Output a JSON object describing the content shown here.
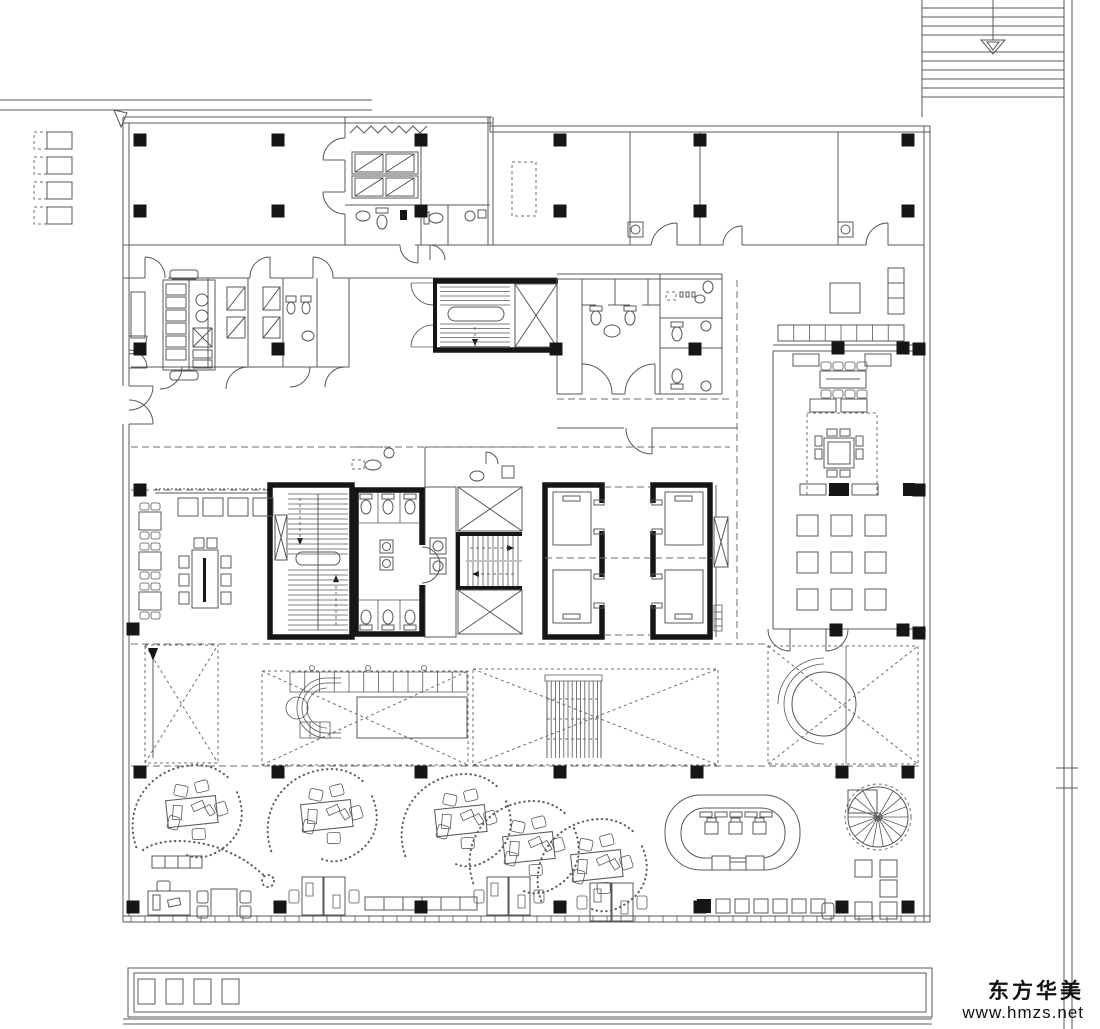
{
  "watermark": {
    "company": "东方华美",
    "website": "www.hmzs.net"
  },
  "palette": {
    "background": "#ffffff",
    "line": "#54585c",
    "dark": "#161616",
    "dashed": "#6b6f73"
  },
  "plan": {
    "columns": [
      [
        140,
        140
      ],
      [
        278,
        140
      ],
      [
        421,
        140
      ],
      [
        560,
        140
      ],
      [
        700,
        140
      ],
      [
        908,
        140
      ],
      [
        140,
        211
      ],
      [
        278,
        211
      ],
      [
        421,
        211
      ],
      [
        560,
        211
      ],
      [
        700,
        211
      ],
      [
        908,
        211
      ],
      [
        140,
        349
      ],
      [
        278,
        349
      ],
      [
        556,
        349
      ],
      [
        695,
        349
      ],
      [
        838,
        348
      ],
      [
        903,
        348
      ],
      [
        919,
        349
      ],
      [
        140,
        490
      ],
      [
        919,
        490
      ],
      [
        133,
        629
      ],
      [
        836,
        630
      ],
      [
        903,
        630
      ],
      [
        919,
        633
      ],
      [
        140,
        772
      ],
      [
        278,
        772
      ],
      [
        421,
        772
      ],
      [
        560,
        772
      ],
      [
        697,
        772
      ],
      [
        842,
        772
      ],
      [
        908,
        772
      ],
      [
        133,
        907
      ],
      [
        280,
        907
      ],
      [
        421,
        907
      ],
      [
        560,
        907
      ],
      [
        700,
        907
      ],
      [
        842,
        907
      ],
      [
        908,
        907
      ]
    ],
    "parking": {
      "x_dash": 34,
      "w_dash": 13,
      "x_solid": 47,
      "w_solid": 25,
      "h": 17,
      "ys": [
        132,
        157,
        182,
        207
      ]
    },
    "exterior_stair": {
      "x1": 922,
      "x2": 1064,
      "tread_ys": [
        8,
        17,
        26,
        35,
        52,
        61,
        70,
        79,
        88,
        97
      ]
    },
    "grid_tables": {
      "cols": [
        797,
        831,
        865
      ],
      "rows": [
        515,
        552,
        589
      ],
      "size": 21
    },
    "right_tables": {
      "size": 17,
      "pos": [
        [
          855,
          860
        ],
        [
          880,
          860
        ],
        [
          880,
          880
        ],
        [
          855,
          902
        ],
        [
          880,
          902
        ]
      ]
    },
    "stools": {
      "x0": 697,
      "step": 19,
      "count": 7,
      "y": 899,
      "size": 14,
      "dark_first": true
    },
    "cafe_tables": {
      "x": 139,
      "w": 22,
      "h": 18,
      "ys": [
        512,
        552,
        592
      ]
    },
    "top_tables_row": {
      "x0": 178,
      "step": 25,
      "count": 4,
      "y": 498,
      "w": 20,
      "h": 18
    },
    "clusters": [
      [
        193,
        813
      ],
      [
        328,
        817
      ],
      [
        462,
        822
      ],
      [
        530,
        849
      ],
      [
        598,
        867
      ]
    ],
    "desk_pairs": [
      [
        302,
        877
      ],
      [
        487,
        877
      ],
      [
        590,
        883
      ]
    ],
    "meeting_chairs": {
      "xs": [
        821,
        833,
        845,
        857
      ],
      "y_top": 362,
      "y_bot": 390
    },
    "mullions": {
      "x0": 131,
      "x1": 917,
      "step": 14,
      "y1": 916,
      "y2": 922
    },
    "bench_row": {
      "x": 778,
      "y": 325,
      "w": 126,
      "h": 16,
      "cells": 8
    }
  }
}
